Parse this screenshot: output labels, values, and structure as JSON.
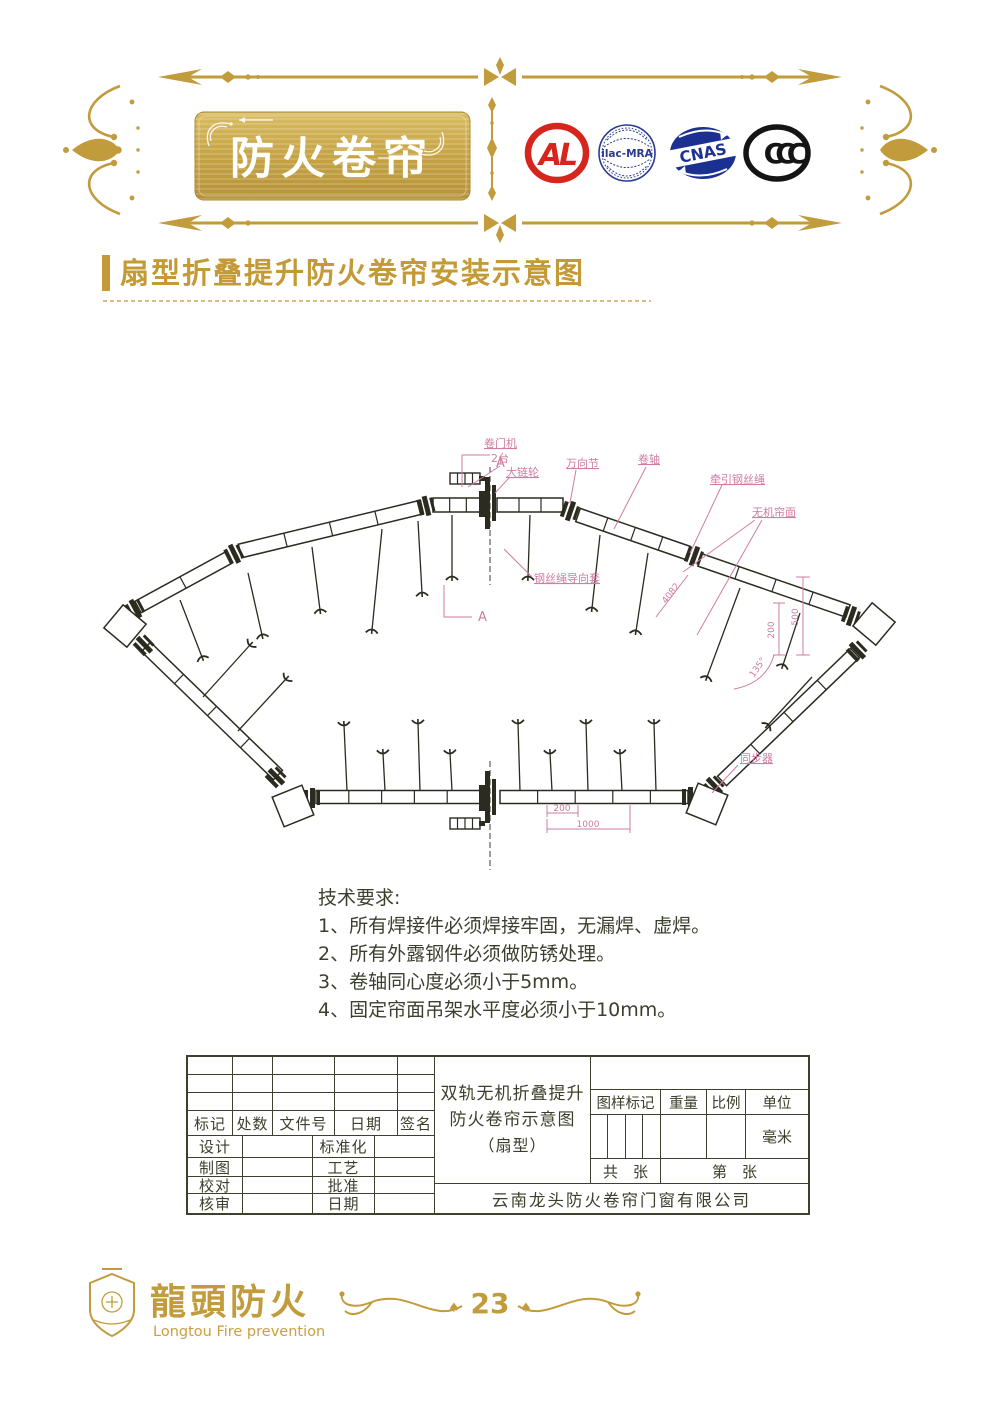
{
  "header": {
    "plaque_title": "防火卷帘",
    "logos": [
      {
        "name": "cal-logo",
        "text": "AL",
        "color": "#d6251c"
      },
      {
        "name": "ilac-mra-logo",
        "text": "ilac-MRA",
        "color": "#2b3a8f"
      },
      {
        "name": "cnas-logo",
        "text": "CNAS",
        "color": "#1c3092"
      },
      {
        "name": "ccc-logo",
        "text": "CCC",
        "color": "#141414"
      }
    ]
  },
  "section": {
    "title": "扇型折叠提升防火卷帘安装示意图"
  },
  "diagram": {
    "labels": {
      "a_top": "A",
      "a_bottom": "A",
      "motor": "卷门机",
      "motor_qty": "2台",
      "sprocket": "大链轮",
      "ujoint": "万向节",
      "shaft": "卷轴",
      "rope": "牵引钢丝绳",
      "curtain": "无机帘面",
      "guide": "钢丝绳导向套",
      "sync": "同步器",
      "dim_4082": "4082",
      "dim_500": "500",
      "dim_200_side": "200",
      "dim_135": "135°",
      "dim_200_bottom": "200",
      "dim_1000": "1000"
    }
  },
  "tech": {
    "title": "技术要求:",
    "items": [
      "1、所有焊接件必须焊接牢固，无漏焊、虚焊。",
      "2、所有外露钢件必须做防锈处理。",
      "3、卷轴同心度必须小于5mm。",
      "4、固定帘面吊架水平度必须小于10mm。"
    ]
  },
  "titleblock": {
    "header_cols": [
      "标记",
      "处数",
      "文件号",
      "日期",
      "签名"
    ],
    "left_rows": [
      [
        "设计",
        "标准化"
      ],
      [
        "制图",
        "工艺"
      ],
      [
        "校对",
        "批准"
      ],
      [
        "核审",
        "日期"
      ]
    ],
    "drawing_title_l1": "双轨无机折叠提升",
    "drawing_title_l2": "防火卷帘示意图",
    "drawing_title_l3": "（扇型）",
    "right_header": [
      "图样标记",
      "重量",
      "比例",
      "单位"
    ],
    "unit_value": "毫米",
    "sheets_total": "共　张",
    "sheet_no": "第　张",
    "company": "云南龙头防火卷帘门窗有限公司"
  },
  "footer": {
    "logo_cn": "龍頭防火",
    "logo_en": "Longtou Fire prevention",
    "page_number": "23"
  },
  "colors": {
    "gold": "#c19b3c",
    "title_gold": "#c39a35",
    "annotation_pink": "#cf7da1",
    "ink": "#2b2b20",
    "table_ink": "#3b3f2b"
  }
}
